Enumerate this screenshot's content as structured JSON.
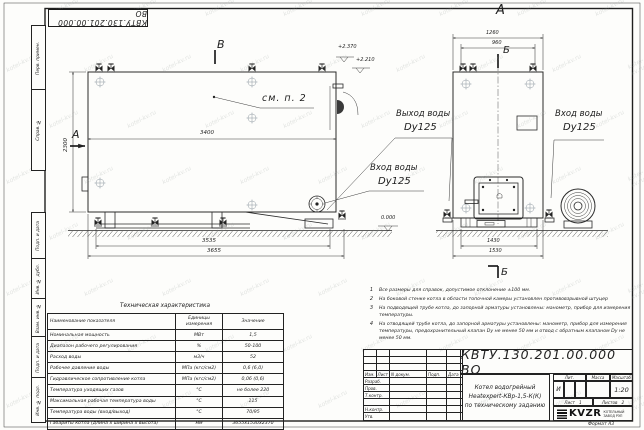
{
  "watermark": "kotel-kv.ru",
  "stamp": {
    "doc_number_rotated": "КВТУ.130.201.00.000  ВО"
  },
  "margin_labels": [
    "Перв. примен.",
    "Справ. №",
    "Подп. и дата",
    "Инв. № дубл.",
    "Взам. инв. №",
    "Подп. и дата",
    "Инв. № подл."
  ],
  "views": {
    "side": {
      "section_mark_b": "В",
      "section_mark_a": "А",
      "callout": "см. п. 2",
      "dims": {
        "width_inner": "3400",
        "height": "2300",
        "width_base": "3535",
        "width_total": "3655"
      },
      "elevations": {
        "top1": "+2.370",
        "top2": "+2.210",
        "ground": "0.000"
      },
      "outlet_label": {
        "line1": "Выход воды",
        "line2": "Dy125"
      },
      "inlet_label": {
        "line1": "Вход воды",
        "line2": "Dy125"
      }
    },
    "front": {
      "view_title": "А",
      "center_mark": "Б",
      "section_mark_bottom": "Б",
      "dims": {
        "top_outer": "1260",
        "top_inner": "960",
        "bottom_inner": "1430",
        "bottom_outer": "1530"
      },
      "inlet_label": {
        "line1": "Вход воды",
        "line2": "Dy125"
      }
    }
  },
  "spec_table": {
    "title": "Техническая характеристика",
    "headers": [
      "Наименование показателя",
      "Единицы измерения",
      "Значение"
    ],
    "rows": [
      [
        "Номинальная мощность",
        "МВт",
        "1,5"
      ],
      [
        "Диапазон рабочего регулирования",
        "%",
        "50-100"
      ],
      [
        "Расход воды",
        "м3/ч",
        "52"
      ],
      [
        "Рабочее давление воды",
        "МПа (кгс/см2)",
        "0,6 (6,0)"
      ],
      [
        "Гидравлическое сопротивление котла",
        "МПа (кгс/см2)",
        "0,06 (0,6)"
      ],
      [
        "Температура уходящих газов",
        "°С",
        "не более 220"
      ],
      [
        "Максимальная рабочая температура воды",
        "°С",
        "115"
      ],
      [
        "Температура воды (вход/выход)",
        "°С",
        "70/95"
      ],
      [
        "Габариты котла (длина х ширина х высота)",
        "мм",
        "3655х1530х2370"
      ]
    ]
  },
  "notes": [
    {
      "n": "1",
      "text": "Все размеры для справок, допустимое отклонение ±100 мм."
    },
    {
      "n": "2",
      "text": "На боковой стенке котла в области топочной камеры установлен противовзрывной штуцер"
    },
    {
      "n": "3",
      "text": "На подводящей трубе котла, до запорной арматуры установлены: манометр, прибор для измерения температуры."
    },
    {
      "n": "4",
      "text": "На отводящей трубе котла, до запорной арматуры установлены: манометр, прибор для измерения температуры, предохранительный клапан Dу не менее 50 мм и отвод с обратным клапаном Dу не менее 50 мм."
    }
  ],
  "title_block": {
    "doc_number": "КВТУ.130.201.00.000  ВО",
    "product_lines": [
      "Котел водогрейный",
      "Heatexpert-КВр-1,5-К(К)",
      "по техническому заданию"
    ],
    "change_header": [
      "Изм.",
      "Лист",
      "N докум.",
      "Подп.",
      "Дата"
    ],
    "sig_labels": [
      "Разраб.",
      "Пров.",
      "Т.контр.",
      "Н.контр.",
      "Утв."
    ],
    "lit_label": "Лит.",
    "lit_value": "И",
    "mass_label": "Масса",
    "scale_label": "Масштаб",
    "scale_value": "1:20",
    "sheet_label": "Лист",
    "sheet_value": "1",
    "sheets_label": "Листов",
    "sheets_value": "2",
    "logo_text": "KVZR",
    "logo_sub1": "КОТЕЛЬНЫЙ",
    "logo_sub2": "ЗАВОД РЭП"
  },
  "format_label": "Формат  А3"
}
